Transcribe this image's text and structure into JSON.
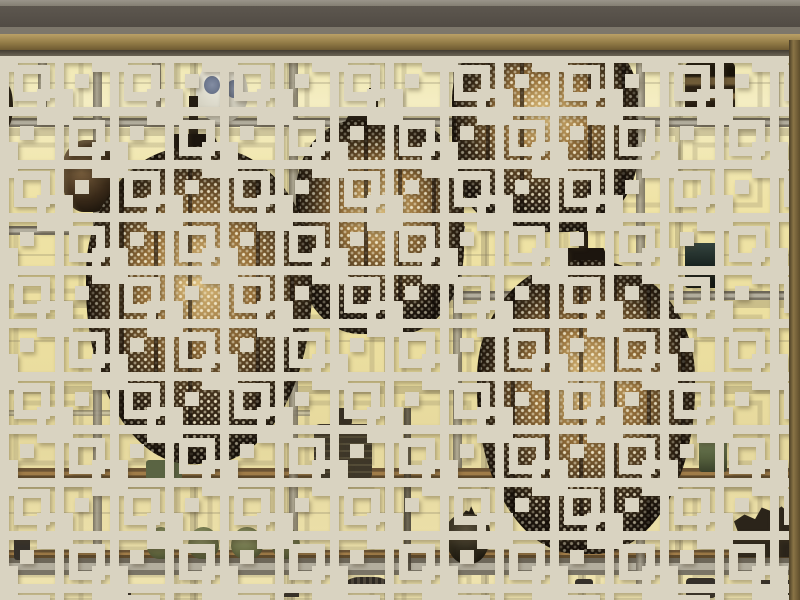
{
  "scene": {
    "description": "Backlit museum display wall with ceramic and bronze vessels on glass shelves, four large pierced-bronze lanterns glowing from within, all seen through a cream-colored Chinese geometric lattice screen.",
    "foreground": "cream wooden lattice screen with interlocking square fretwork",
    "lantern_count": 4,
    "objects": [
      {
        "label": "blue-and-white porcelain vase",
        "shelf": "top left"
      },
      {
        "label": "round polished bronze vessel",
        "shelf": "upper left"
      },
      {
        "label": "small bronze box",
        "shelf": "top right"
      },
      {
        "label": "dark teal square vessel",
        "shelf": "middle right"
      },
      {
        "label": "square archaic bronze vessel with knob",
        "shelf": "lower middle"
      },
      {
        "label": "green rectangular vessel",
        "shelf": "lower left"
      },
      {
        "label": "four celadon globular jars",
        "shelf": "bottom left"
      },
      {
        "label": "dark lidded jar with small bird figure",
        "shelf": "bottom middle"
      },
      {
        "label": "scholar's rock",
        "shelf": "bottom right"
      },
      {
        "label": "celadon arch-shaped object",
        "shelf": "lower right"
      },
      {
        "label": "small ribbed round box and miniature figures",
        "shelf": "bottom ledge"
      }
    ]
  },
  "palette": {
    "glow-bright": "#f4ecc1",
    "glow-mid": "#ecdf9f",
    "lattice-cream": "#d9d3c1",
    "band-dark": "#57514a",
    "brass": "#a78e57",
    "lantern-dark": "#241a10",
    "lantern-glow": "#dfc180",
    "mesh-cream": "#efe5c4",
    "celadon-green": "#6b7049",
    "porcelain-white": "#e9e7dc",
    "porcelain-blue": "#52618a",
    "structure-gray": "#8f8a7d"
  }
}
